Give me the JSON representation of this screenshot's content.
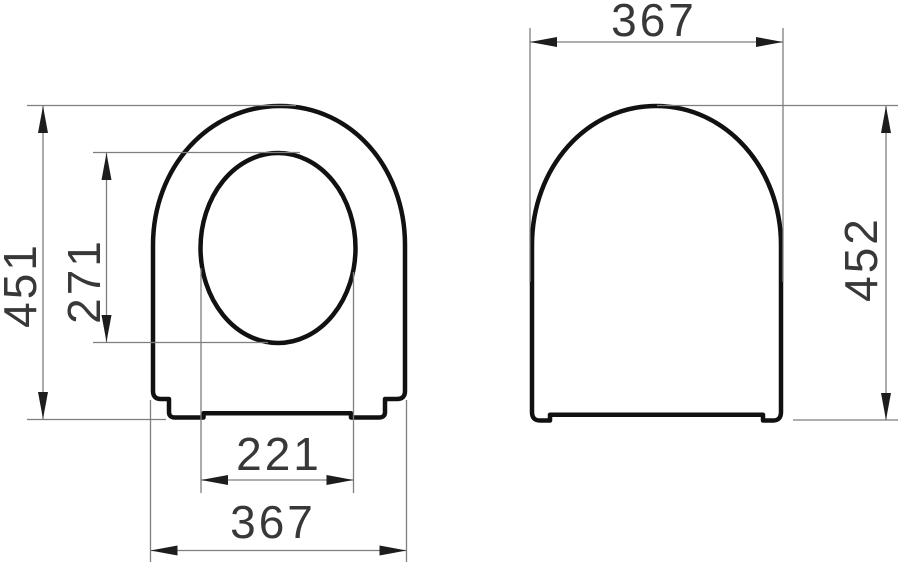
{
  "drawing": {
    "title": "Toilet seat and cover - dimensional drawing (two views)",
    "views": {
      "front": {
        "label": "front-view-seat-with-ring-opening",
        "dimensions": {
          "overall_height_mm": "451",
          "inner_opening_height_mm": "271",
          "inner_opening_width_mm": "221",
          "overall_width_mm": "367"
        }
      },
      "side": {
        "label": "closed-cover-view",
        "dimensions": {
          "overall_width_mm": "367",
          "overall_height_mm": "452"
        }
      }
    },
    "style": {
      "background_color": "#ffffff",
      "outline_color": "#111111",
      "dimension_line_color": "#7e7e7e",
      "arrow_color": "#1d1d1d",
      "text_color": "#383838"
    }
  }
}
